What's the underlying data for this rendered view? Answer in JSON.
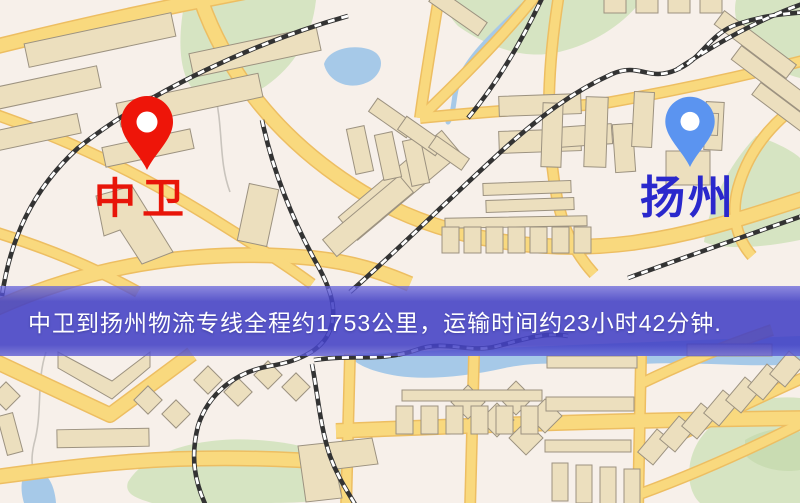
{
  "banner": {
    "text": "中卫到扬州物流专线全程约1753公里，运输时间约23小时42分钟."
  },
  "origin": {
    "label": "中卫",
    "pin": "red-pin"
  },
  "destination": {
    "label": "扬州",
    "pin": "blue-pin"
  },
  "route": {
    "distance_text": "约1753公里",
    "duration_text": "约23小时42分钟"
  },
  "colors": {
    "map_bg": "#f7f0ea",
    "road_fill": "#f9d97e",
    "road_casing": "#edbe62",
    "building": "#ecdfbe",
    "park": "#d6e4c2",
    "park_dark": "#c9dcb2",
    "water": "#a6c9e8",
    "railway": "#333333",
    "origin_pin": "#ee1509",
    "origin_label": "#e81509",
    "destination_pin": "#5b94f0",
    "destination_label": "#2a28cc",
    "banner_text": "#ffffff"
  }
}
